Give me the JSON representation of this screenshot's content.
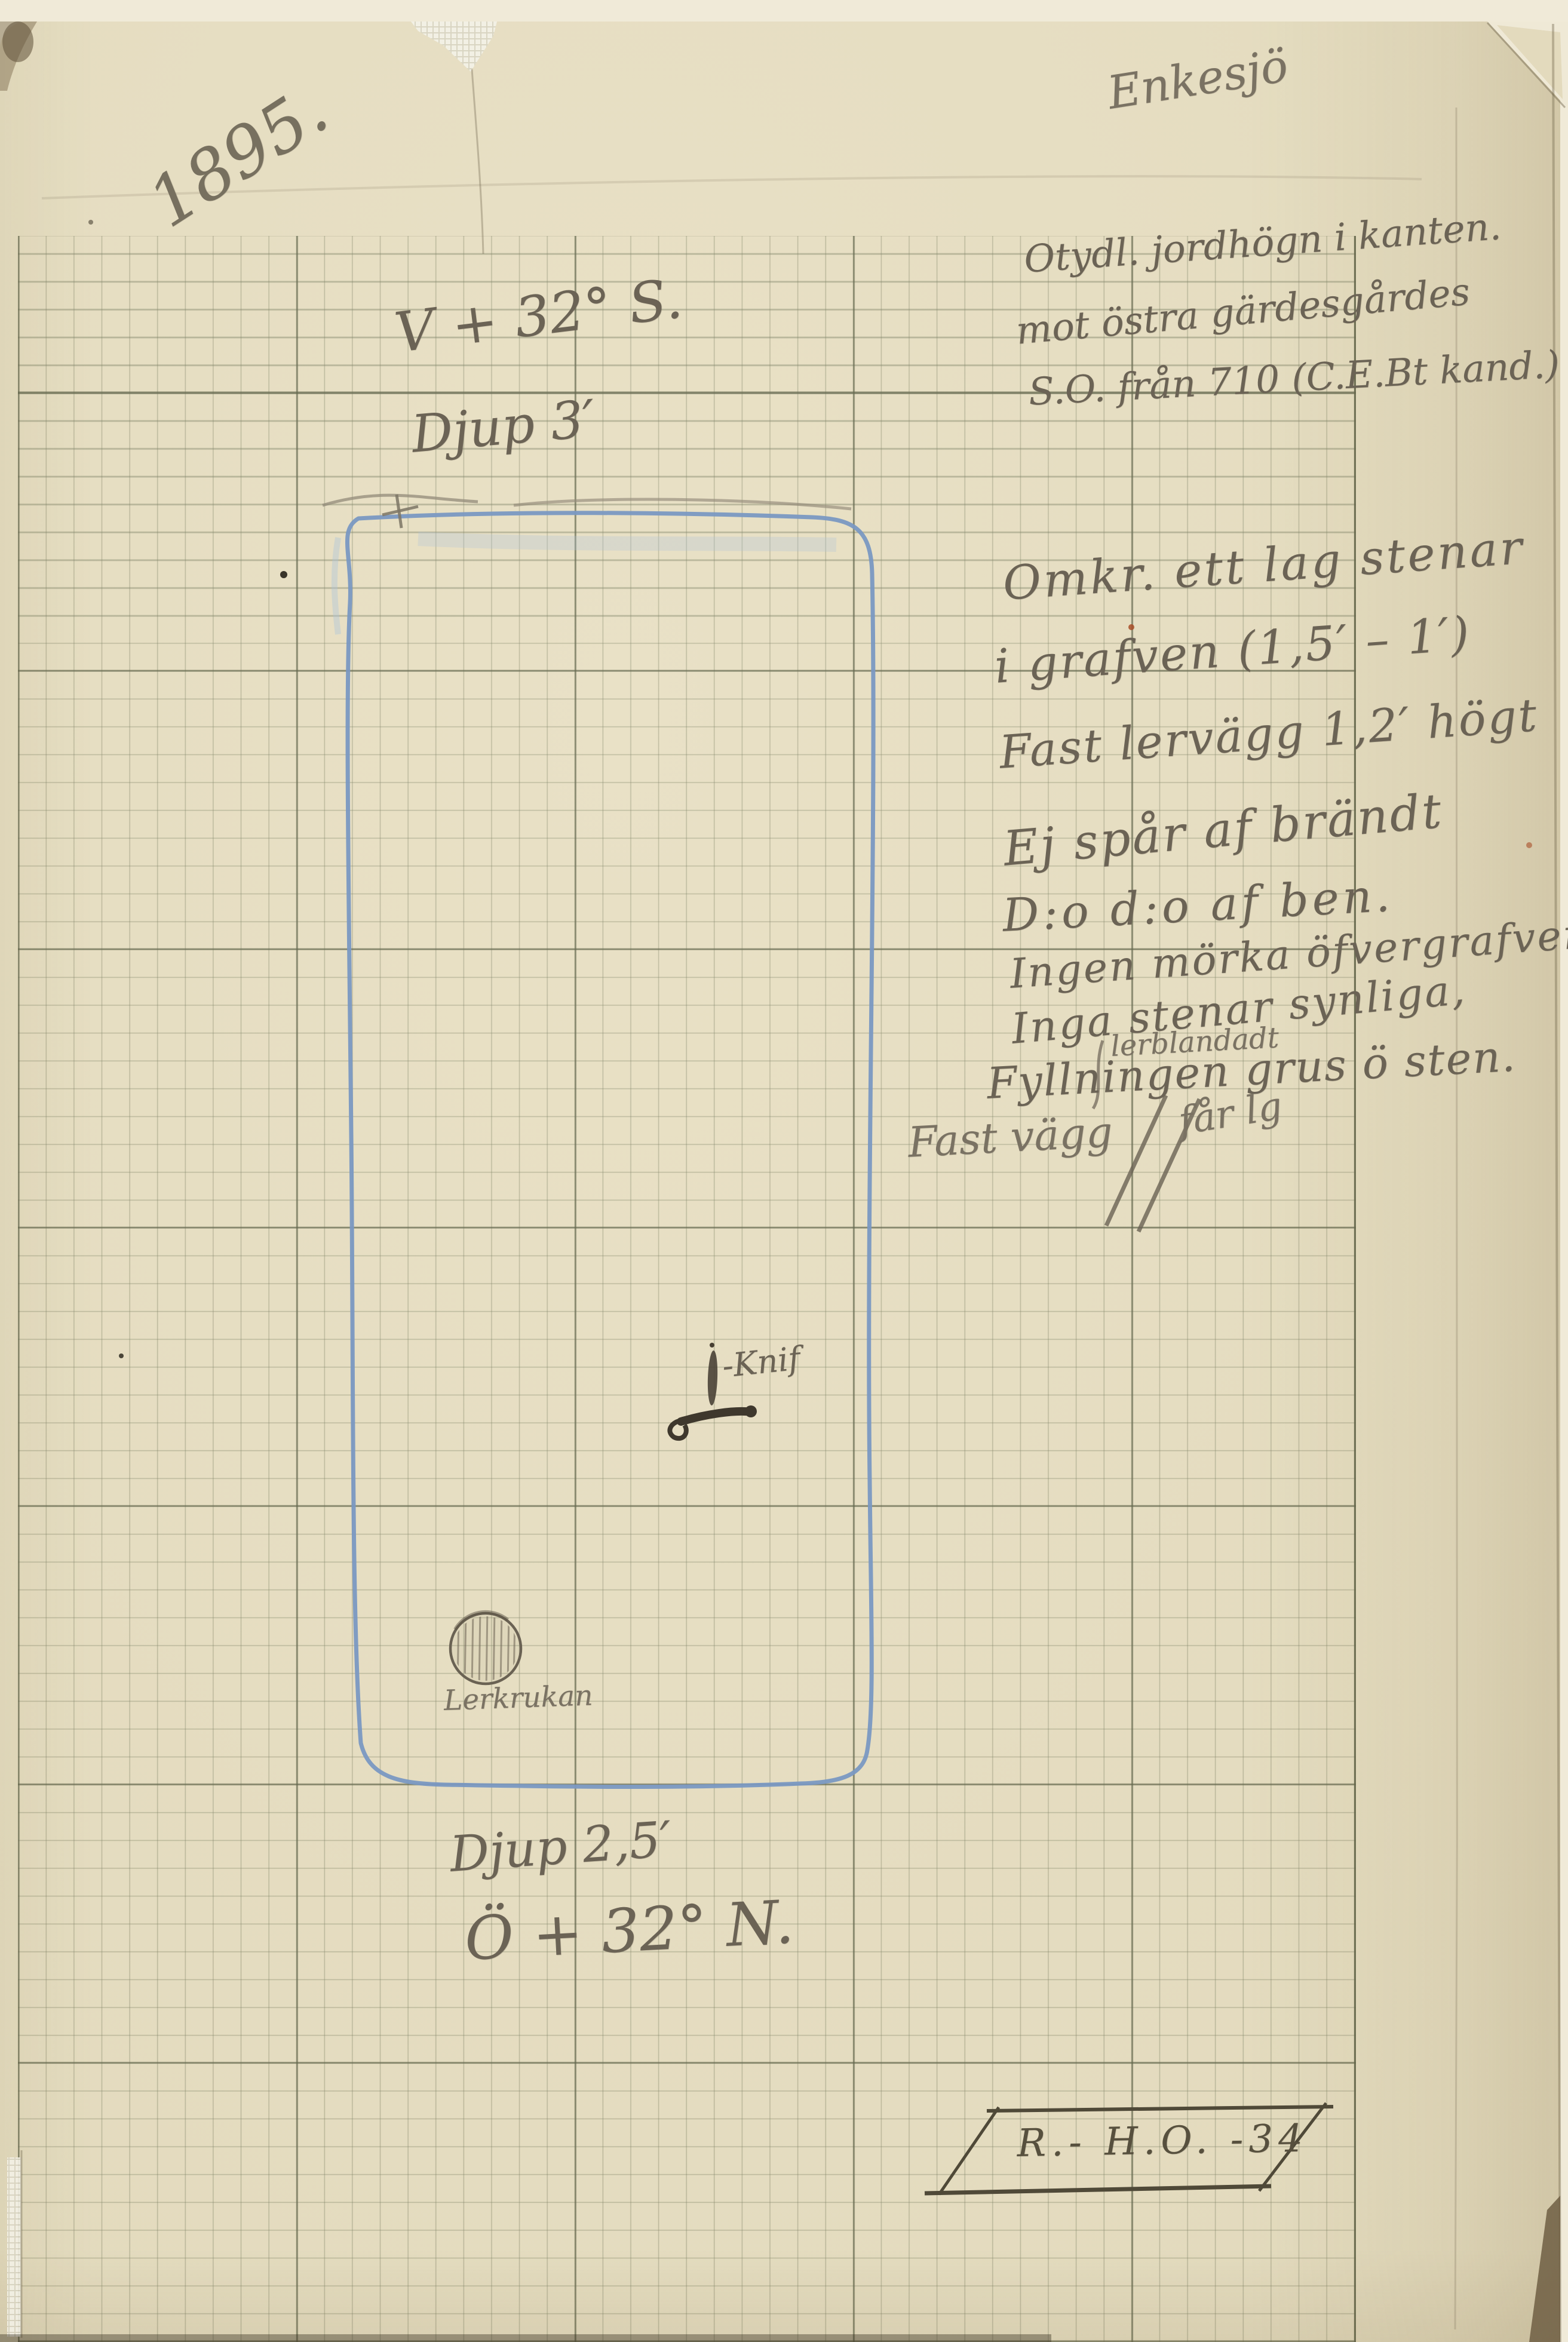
{
  "document": {
    "year": "1895.",
    "signature": "Enkesjö",
    "header_note": [
      "Otydl. jordhögn i kanten.",
      "mot östra gärdesgårdes",
      "S.O. från 710 (C.E.Bt kand.)"
    ],
    "plan": {
      "bearing_top": "V + 32° S.",
      "depth_top": "Djup 3′",
      "depth_bottom": "Djup 2,5′",
      "bearing_bottom": "Ö + 32° N.",
      "knife_label": "-Knif",
      "pot_label": "Lerkrukan"
    },
    "notes": [
      "Omkr. ett lag stenar",
      "i grafven (1,5′ – 1′)",
      "Fast lervägg 1,2′ högt",
      "Ej spår af brändt",
      "D:o  d:o  af ben.",
      "Ingen mörka öfvergrafven",
      "Inga stenar synliga,",
      "lerblandadt",
      "Fyllningen  grus ö sten.",
      "Fast vägg",
      "får lg"
    ],
    "id_box": "R.- H.O. -34",
    "colors": {
      "paper": "#e8e0c3",
      "scan_background": "#f0ead8",
      "grid_minor": "#7d806a",
      "grid_major": "#60644a",
      "pencil": "#6b6355",
      "blue_pencil": "#7a98c2"
    }
  }
}
